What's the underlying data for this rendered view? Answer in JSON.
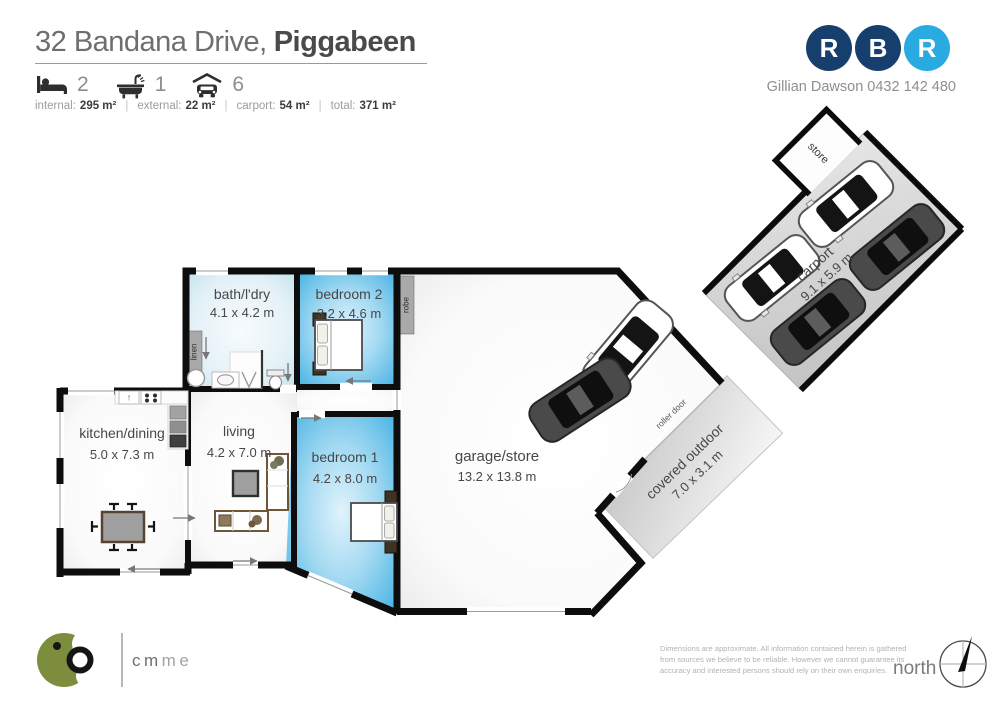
{
  "header": {
    "address_line": {
      "regular": "32 Bandana Drive,",
      "bold": "Piggabeen"
    },
    "beds": "2",
    "baths": "1",
    "cars": "6",
    "sep": "|",
    "stats": [
      {
        "label": "internal:",
        "value": "295 m²"
      },
      {
        "label": "external:",
        "value": "22 m²"
      },
      {
        "label": "carport:",
        "value": "54 m²"
      },
      {
        "label": "total:",
        "value": "371 m²"
      }
    ]
  },
  "agent": {
    "letters": [
      "R",
      "B",
      "R"
    ],
    "contact": "Gillian Dawson 0432 142 480",
    "navy": "#173f6d",
    "light_blue": "#29abe2"
  },
  "rooms": {
    "bath": {
      "name": "bath/l'dry",
      "dims": "4.1 x 4.2 m"
    },
    "bedroom2": {
      "name": "bedroom 2",
      "dims": "3.2 x 4.6 m"
    },
    "kitchen": {
      "name": "kitchen/dining",
      "dims": "5.0 x 7.3 m"
    },
    "living": {
      "name": "living",
      "dims": "4.2 x 7.0 m"
    },
    "bedroom1": {
      "name": "bedroom 1",
      "dims": "4.2 x 8.0 m"
    },
    "garage": {
      "name": "garage/store",
      "dims": "13.2 x 13.8 m"
    },
    "covered": {
      "name": "covered outdoor",
      "dims": "7.0 x 3.1 m"
    },
    "carport": {
      "name": "carport",
      "dims": "9.1 x 5.9 m"
    },
    "store": {
      "name": "store"
    },
    "robe": "robe",
    "linen": "linen",
    "roller_door": "roller door",
    "fridge": "f"
  },
  "footer": {
    "brand": {
      "cm": "cm",
      "media": "media"
    },
    "disclaimer": [
      "Dimensions are approximate.  All information contained herein is gathered",
      "from sources we believe to be reliable.  However we cannot guarantee its",
      "accuracy and interested persons should rely on their own enquiries."
    ],
    "north": "north"
  }
}
